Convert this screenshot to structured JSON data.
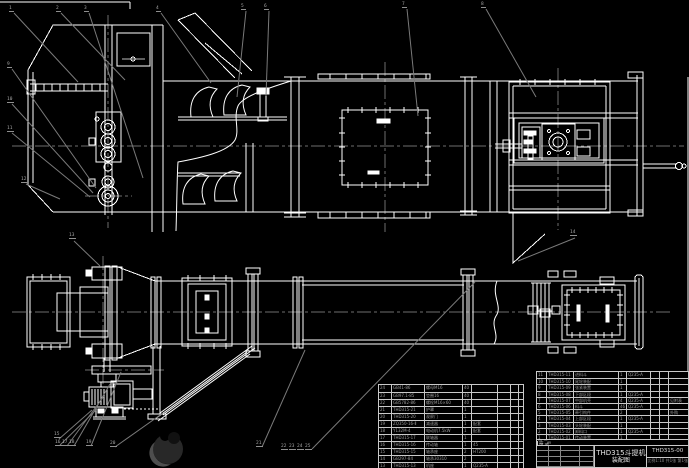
{
  "colors": {
    "background": "#000000",
    "line": "#ffffff",
    "centerline": "#6e6e6e",
    "leader": "#7a7a7a",
    "table_grid": "#c9c9c9",
    "table_text": "#9b9b9b",
    "title_text": "#e6e6e6"
  },
  "title_block": {
    "drawing_title_line1": "THD315斗提机",
    "drawing_title_line2": "装配图",
    "drawing_number": "THD315-00",
    "footer_note": "比例1:10 共1张 第1张",
    "header": [
      [
        "序号",
        "代 号",
        "名 称",
        "数量",
        "材 料",
        "单重",
        "总重",
        "备注"
      ]
    ]
  },
  "bom_left": {
    "rows": [
      [
        "24",
        "GB41-86",
        "螺母M16",
        "40",
        "",
        "",
        "",
        ""
      ],
      [
        "23",
        "GB97.1-85",
        "垫圈16",
        "40",
        "",
        "",
        "",
        ""
      ],
      [
        "22",
        "GB5782-86",
        "螺栓M16×60",
        "40",
        "",
        "",
        "",
        ""
      ],
      [
        "21",
        "THD315-21",
        "护罩",
        "1",
        "",
        "",
        "",
        ""
      ],
      [
        "20",
        "THD315-20",
        "观察门",
        "1",
        "",
        "",
        "",
        ""
      ],
      [
        "19",
        "ZQ350-16-Ⅱ",
        "减速器",
        "1",
        "配套",
        "",
        "",
        ""
      ],
      [
        "18",
        "Y132M-4",
        "电动机7.5kW",
        "1",
        "配套",
        "",
        "",
        ""
      ],
      [
        "17",
        "THD315-17",
        "联轴器",
        "1",
        "",
        "",
        "",
        ""
      ],
      [
        "16",
        "THD315-16",
        "传动轴",
        "1",
        "45",
        "",
        "",
        ""
      ],
      [
        "15",
        "THD315-15",
        "轴承座",
        "2",
        "HT200",
        "",
        "",
        ""
      ],
      [
        "14",
        "GB297-84",
        "轴承30310",
        "2",
        "",
        "",
        "",
        ""
      ],
      [
        "13",
        "THD315-13",
        "机座",
        "1",
        "Q235-A",
        "",
        "",
        ""
      ]
    ]
  },
  "bom_right": {
    "rows": [
      [
        "11",
        "THD315-11",
        "进料斗",
        "1",
        "Q235-A",
        "",
        "",
        ""
      ],
      [
        "10",
        "THD315-10",
        "尾轮装配",
        "1",
        "",
        "",
        "",
        ""
      ],
      [
        "9",
        "THD315-09",
        "张紧装置",
        "1",
        "",
        "",
        "",
        ""
      ],
      [
        "8",
        "THD315-08",
        "下部区段",
        "1",
        "Q235-A",
        "",
        "",
        ""
      ],
      [
        "7",
        "THD315-07",
        "中部机壳",
        "4",
        "Q235-A",
        "",
        "",
        "见附表"
      ],
      [
        "6",
        "THD315-06",
        "料斗",
        "46",
        "Q235-A",
        "",
        "",
        ""
      ],
      [
        "5",
        "THD315-05",
        "牵引构件",
        "2",
        "",
        "",
        "",
        "外购"
      ],
      [
        "4",
        "THD315-04",
        "上部区段",
        "1",
        "Q235-A",
        "",
        "",
        ""
      ],
      [
        "3",
        "THD315-03",
        "头轮装配",
        "1",
        "",
        "",
        "",
        ""
      ],
      [
        "2",
        "THD315-02",
        "卸料口",
        "1",
        "Q235-A",
        "",
        "",
        ""
      ],
      [
        "1",
        "THD315-01",
        "传动装置",
        "1",
        "",
        "",
        "",
        ""
      ]
    ]
  },
  "callouts": [
    {
      "label": "1",
      "x": 9,
      "y": 6
    },
    {
      "label": "2",
      "x": 56,
      "y": 6
    },
    {
      "label": "3",
      "x": 84,
      "y": 6
    },
    {
      "label": "4",
      "x": 156,
      "y": 6
    },
    {
      "label": "5",
      "x": 241,
      "y": 4
    },
    {
      "label": "6",
      "x": 264,
      "y": 4
    },
    {
      "label": "7",
      "x": 402,
      "y": 2
    },
    {
      "label": "8",
      "x": 481,
      "y": 2
    },
    {
      "label": "9",
      "x": 7,
      "y": 62
    },
    {
      "label": "10",
      "x": 7,
      "y": 97
    },
    {
      "label": "11",
      "x": 7,
      "y": 126
    },
    {
      "label": "12",
      "x": 21,
      "y": 177
    },
    {
      "label": "13",
      "x": 69,
      "y": 233
    },
    {
      "label": "14",
      "x": 570,
      "y": 230
    },
    {
      "label": "15",
      "x": 54,
      "y": 432
    },
    {
      "label": "16",
      "x": 55,
      "y": 440
    },
    {
      "label": "17",
      "x": 62,
      "y": 440
    },
    {
      "label": "18",
      "x": 69,
      "y": 440
    },
    {
      "label": "19",
      "x": 86,
      "y": 440
    },
    {
      "label": "20",
      "x": 110,
      "y": 441
    },
    {
      "label": "21",
      "x": 256,
      "y": 441
    },
    {
      "label": "22",
      "x": 281,
      "y": 444
    },
    {
      "label": "23",
      "x": 289,
      "y": 444
    },
    {
      "label": "24",
      "x": 297,
      "y": 444
    },
    {
      "label": "25",
      "x": 305,
      "y": 444
    }
  ]
}
